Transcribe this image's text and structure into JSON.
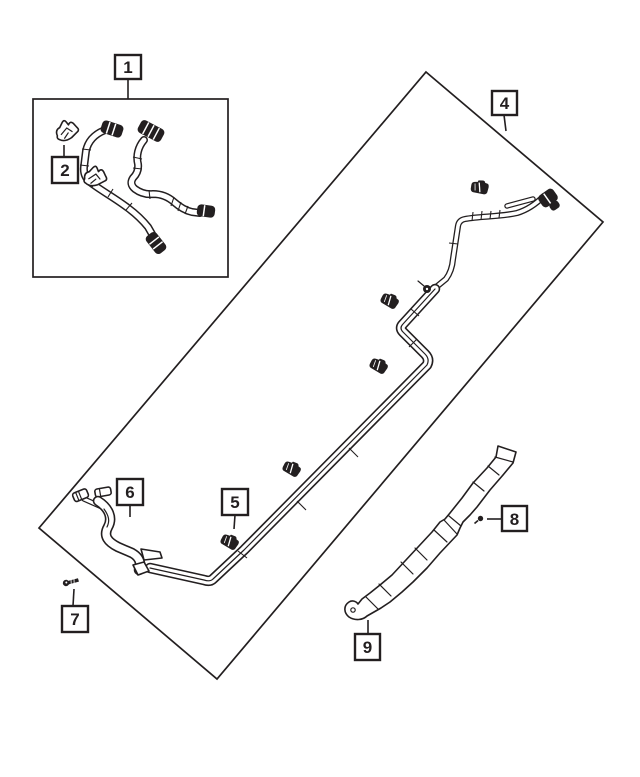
{
  "colors": {
    "ink": "#231f20",
    "paper": "#ffffff"
  },
  "callouts": [
    {
      "label": "1"
    },
    {
      "label": "2"
    },
    {
      "label": "4"
    },
    {
      "label": "5"
    },
    {
      "label": "6"
    },
    {
      "label": "7"
    },
    {
      "label": "8"
    },
    {
      "label": "9"
    }
  ]
}
